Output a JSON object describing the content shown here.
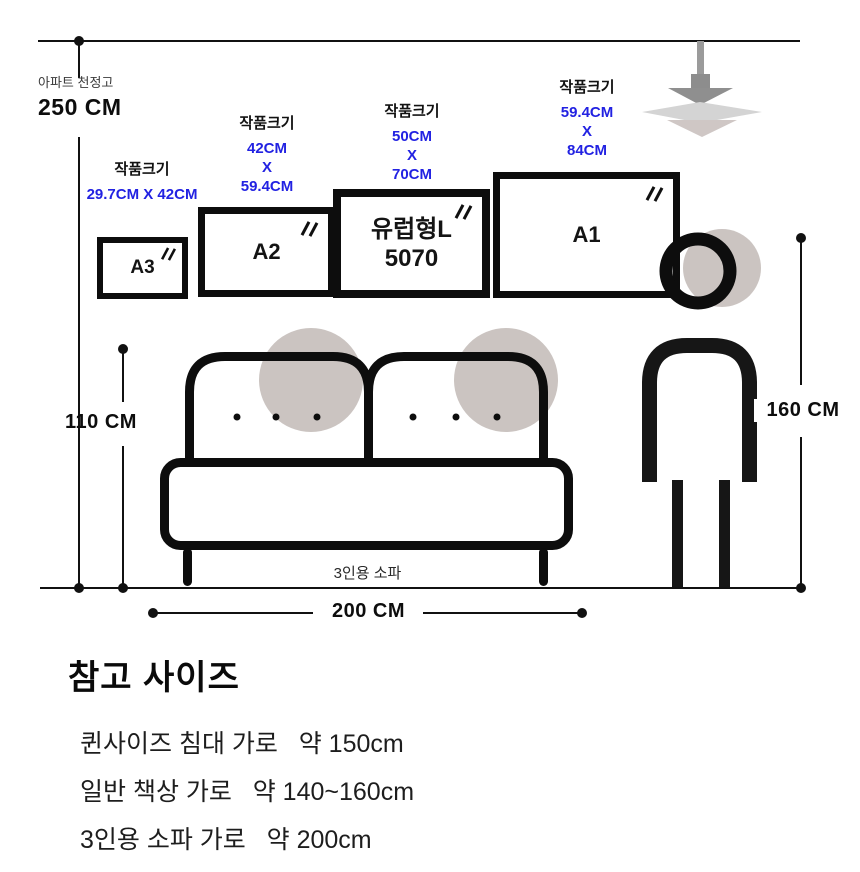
{
  "measurements": {
    "ceiling": {
      "label": "아파트 천정고",
      "value": "250 CM"
    },
    "sofa_height": "110 CM",
    "person_height": "160 CM",
    "sofa_width": "200 CM"
  },
  "frames": [
    {
      "name": "A3",
      "label": "작품크기",
      "size_lines": [
        "29.7CM X 42CM"
      ]
    },
    {
      "name": "A2",
      "label": "작품크기",
      "size_lines": [
        "42CM",
        "X",
        "59.4CM"
      ]
    },
    {
      "name": "유럽형L",
      "name2": "5070",
      "label": "작품크기",
      "size_lines": [
        "50CM",
        "X",
        "70CM"
      ]
    },
    {
      "name": "A1",
      "label": "작품크기",
      "size_lines": [
        "59.4CM",
        "X",
        "84CM"
      ]
    }
  ],
  "sofa": {
    "label": "3인용 소파"
  },
  "reference": {
    "title": "참고 사이즈",
    "items": [
      "퀸사이즈 침대 가로   약 150cm",
      "일반 책상 가로   약 140~160cm",
      "3인용 소파 가로   약 200cm"
    ]
  },
  "icons": {
    "glare": "frame-glare-icon",
    "lamp": "pendant-lamp-icon",
    "person": "person-figure",
    "sofa": "three-seat-sofa"
  },
  "colors": {
    "accent_blue": "#2222E2",
    "circle_beige": "#CBC4C1",
    "line": "#111111"
  }
}
